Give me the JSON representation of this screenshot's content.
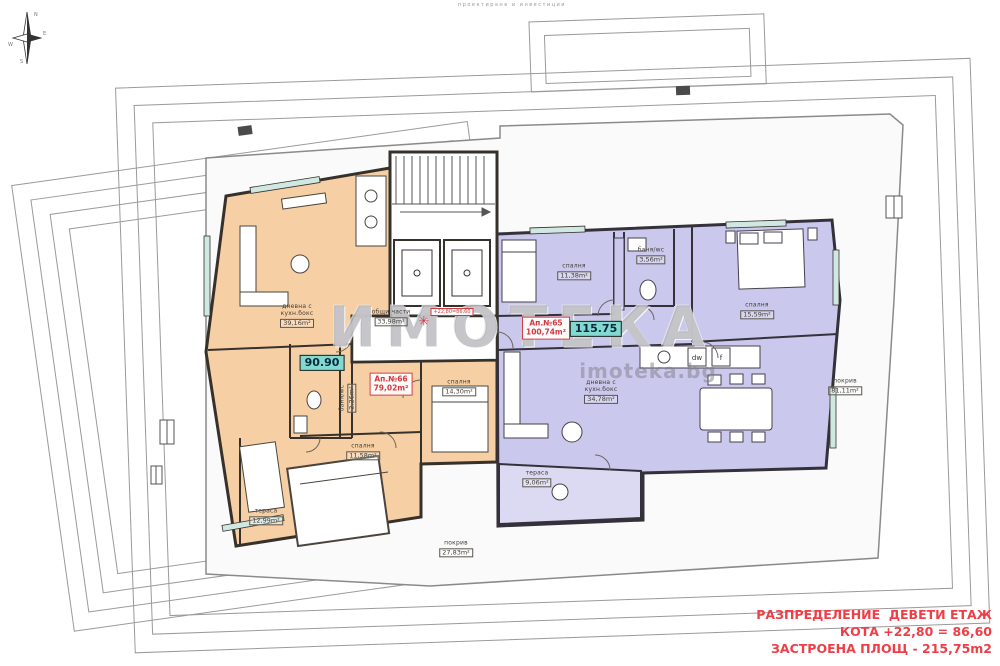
{
  "header_note": "проектиране и инвестиции",
  "compass": {
    "n": "N",
    "e": "E",
    "s": "S",
    "w": "W"
  },
  "watermark": {
    "line1": "ИМОТЕКА",
    "line2": "imoteka.bg"
  },
  "elevation_marker": {
    "symbol": "✳",
    "text": "+22,80=86,60"
  },
  "common_area": {
    "name": "общи части",
    "area": "33,98m²"
  },
  "apartments": [
    {
      "label": "Ап.№66",
      "area": "79,02m²",
      "price": "90.90"
    },
    {
      "label": "Ап.№65",
      "area": "100,74m²",
      "price": "115.75"
    }
  ],
  "rooms": [
    {
      "name": "дневна с кухн.бокс",
      "area": "39,16m²"
    },
    {
      "name": "баня/wc",
      "area": "2,26m²"
    },
    {
      "name": "спалня",
      "area": "14,30m²"
    },
    {
      "name": "спалня",
      "area": "11,58m²"
    },
    {
      "name": "тераса",
      "area": "12,99m²"
    },
    {
      "name": "спалня",
      "area": "11,38m²"
    },
    {
      "name": "баня/wc",
      "area": "3,56m²"
    },
    {
      "name": "спалня",
      "area": "15,59m²"
    },
    {
      "name": "дневна с кухн.бокс",
      "area": "34,78m²"
    },
    {
      "name": "тераса",
      "area": "9,06m²"
    },
    {
      "name": "покрив",
      "area": "27,83m²"
    },
    {
      "name": "покрив",
      "area": "81,11m²"
    }
  ],
  "appliances": {
    "dw": "dw",
    "f": "f"
  },
  "title_block": {
    "line1": "РАЗПРЕДЕЛЕНИЕ  ДЕВЕТИ ЕТАЖ",
    "line2": "КОТА +22,80 = 86,60",
    "line3": "ЗАСТРОЕНА ПЛОЩ - 215,75m2"
  },
  "colors": {
    "apartment66_fill": "#f7cfa4",
    "apartment65_fill": "#cac8ec",
    "terrace_fill": "#dcdaf2",
    "wall": "#37312b",
    "accent_red": "#ee3e47",
    "badge_teal": "#82d9d0",
    "outline_gray": "#9a9a9a"
  }
}
